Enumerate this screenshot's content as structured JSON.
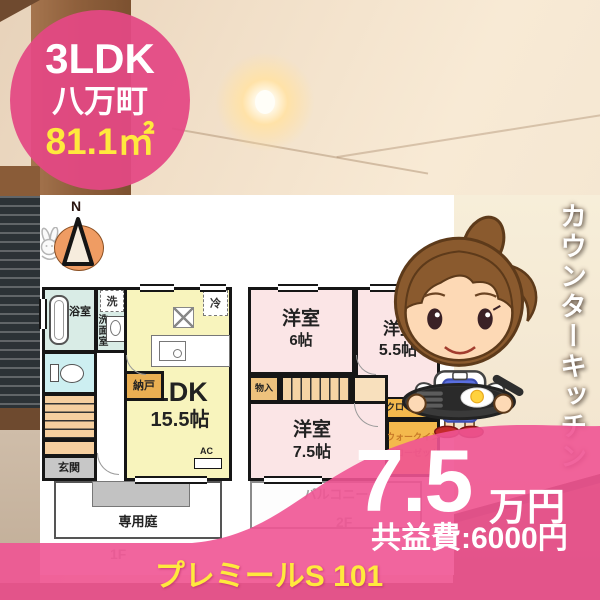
{
  "badge": {
    "layout": "3LDK",
    "town": "八万町",
    "area": "81.1㎡"
  },
  "side_banner": {
    "text": "カウンターキッチン"
  },
  "price_block": {
    "rent": "7.5",
    "rent_unit": "万円",
    "common_fee": "共益費:6000円"
  },
  "footer": {
    "property_name": "プレミールS 101"
  },
  "compass": {
    "north": "N"
  },
  "floor1": {
    "floor_label": "1F",
    "bath": "浴室",
    "washroom": "洗面室",
    "washer": "洗",
    "fridge": "冷",
    "ldk_name": "LDK",
    "ldk_size": "15.5帖",
    "storage": "納戸",
    "entrance": "玄関",
    "ac": "AC",
    "garden": "専用庭"
  },
  "floor2": {
    "floor_label": "2F",
    "room1_name": "洋室",
    "room1_size": "6帖",
    "room2_name": "洋室",
    "room2_size": "5.5帖",
    "closet_small": "物入",
    "closet": "クローゼット",
    "wic_line1": "ウォークイン",
    "wic_line2": "クローゼット",
    "room3_name": "洋室",
    "room3_size": "7.5帖",
    "balcony": "バルコニー"
  },
  "colors": {
    "accent_pink": "#ee5a92",
    "badge_pink": "#e34884",
    "highlight_yellow": "#ffe93d",
    "ldk_yellow": "#f8f4bd",
    "wet_area_cyan": "#d9ece6",
    "toilet_cyan": "#cdeff1",
    "bedroom_pink": "#fbe5e6",
    "stairs_salmon": "#f6cf9f",
    "closet_orange": "#f4b94d",
    "storage_tan": "#eaaf52",
    "entrance_gray": "#c7c7c7"
  }
}
